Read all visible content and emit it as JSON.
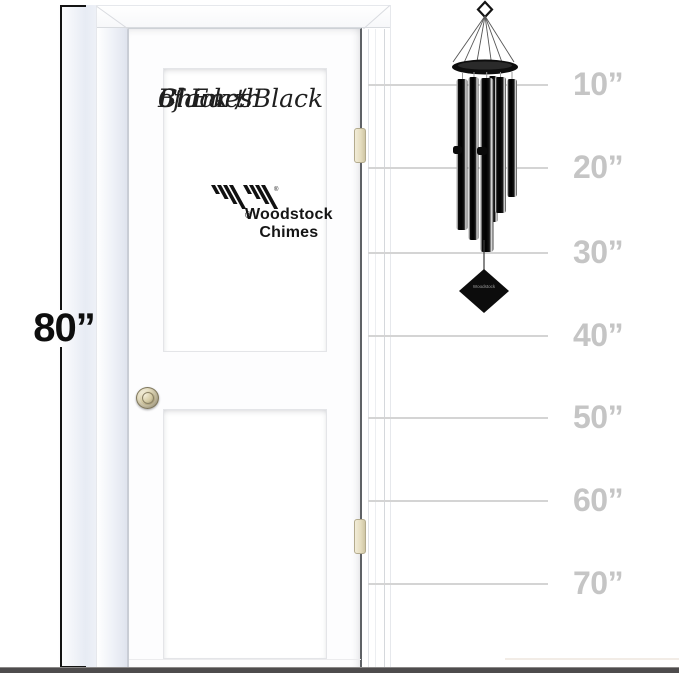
{
  "dimension": {
    "label": "80”"
  },
  "door": {
    "title_line1": "Chimes",
    "title_line2": "of Earth",
    "title_line3": "Black / Black",
    "brand": "Woodstock Chimes",
    "registered_mark": "®"
  },
  "chime": {
    "sail_text": "Woodstock",
    "tube_count": 6
  },
  "ruler": {
    "unit": "inches",
    "marks": [
      {
        "label": "10”",
        "y": 84
      },
      {
        "label": "20”",
        "y": 167
      },
      {
        "label": "30”",
        "y": 252
      },
      {
        "label": "40”",
        "y": 335
      },
      {
        "label": "50”",
        "y": 417
      },
      {
        "label": "60”",
        "y": 500
      },
      {
        "label": "70”",
        "y": 583
      }
    ]
  },
  "colors": {
    "ruler_line": "#d4d4d4",
    "ruler_label": "#c5c5c5",
    "dimension_text": "#0e0e0e",
    "chime_black": "#0c0c0c",
    "floor": "#4e4c4d"
  }
}
